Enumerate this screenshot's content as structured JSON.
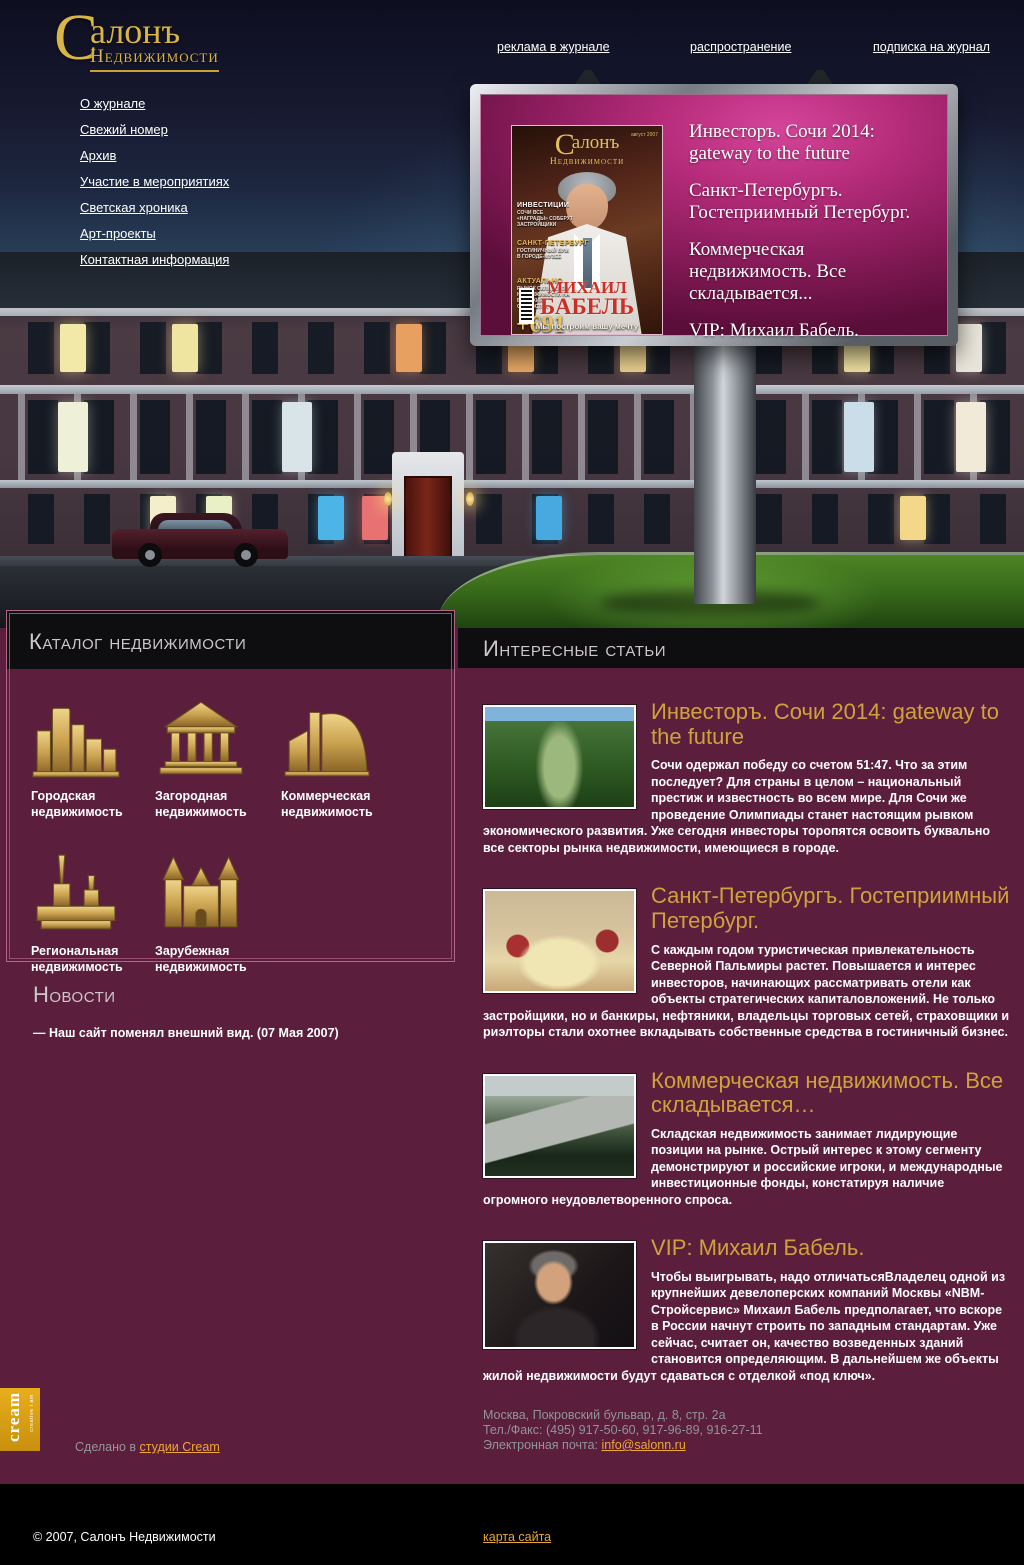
{
  "header": {
    "logo": {
      "initial": "С",
      "word1": "алонъ",
      "word2": "Недвижимости"
    },
    "top_links": [
      {
        "label": "реклама в журнале"
      },
      {
        "label": "распространение"
      },
      {
        "label": "подписка на журнал"
      }
    ]
  },
  "nav": {
    "items": [
      "О журнале",
      "Свежий номер",
      "Архив",
      "Участие в мероприятиях",
      "Светская хроника",
      "Арт-проекты",
      "Контактная информация"
    ]
  },
  "billboard": {
    "headlines": [
      "Инвесторъ. Сочи 2014: gateway to the future",
      "Санкт-Петербургъ. Гостеприимный Петербург.",
      "Коммерческая недвижимость. Все складывается...",
      "VIP: Михаил Бабель."
    ],
    "cover": {
      "logo_initial": "С",
      "logo_word": "алонъ",
      "logo_sub": "Недвижимости",
      "date": "август 2007",
      "rubric1": "ИНВЕСТИЦИИ",
      "rubric1_sub": "СОЧИ ВСЕ «НАГРАДЫ» СОБЕРУТ ЗАСТРОЙЩИКИ",
      "rubric2": "САНКТ-ПЕТЕРБУРГ",
      "rubric2_sub": "ГОСТИНИЧНЫЙ БУМ В ГОРОДЕ-МУЗЕЕ",
      "rubric3": "АКТУАЛЬНО",
      "rubric3_sub": "РЫНОК СКЛАДСКОЙ НЕДВИЖИМОСТИ НА ВЫСОКИХ СКОРОСТЯХ",
      "number": "+691",
      "person_line1": "МИХАИЛ",
      "person_line2": "БАБЕЛЬ",
      "slogan": "Мы построим вашу мечту"
    }
  },
  "catalog": {
    "title": "Каталог недвижимости",
    "items": [
      {
        "label": "Городская недвижимость",
        "icon": "city-buildings-icon"
      },
      {
        "label": "Загородная недвижимость",
        "icon": "country-house-icon"
      },
      {
        "label": "Коммерческая недвижимость",
        "icon": "commercial-building-icon"
      },
      {
        "label": "Региональная недвижимость",
        "icon": "fortress-spire-icon"
      },
      {
        "label": "Зарубежная недвижимость",
        "icon": "castle-icon"
      }
    ]
  },
  "news": {
    "title": "Новости",
    "items": [
      "— Наш сайт поменял внешний вид. (07 Мая 2007)"
    ]
  },
  "articles": {
    "title": "Интересные статьи",
    "items": [
      {
        "title": "Инвесторъ. Сочи 2014: gateway to the future",
        "body": "Сочи одержал победу со счетом 51:47. Что за этим последует? Для страны в целом – национальный престиж и известность во всем мире. Для Сочи же проведение Олимпиады станет настоящим рывком экономического развития. Уже сегодня инвесторы торопятся освоить буквально все секторы рынка недвижимости, имеющиеся в городе."
      },
      {
        "title": "Санкт-Петербургъ. Гостеприимный Петербург.",
        "body": "С каждым годом туристическая привлекательность Северной Пальмиры растет. Повышается и интерес инвесторов, начинающих рассматривать отели как объекты стратегических капиталовложений. Не только застройщики, но и банкиры, нефтяники, владельцы торговых сетей, страховщики и риэлторы стали охотнее вкладывать собственные средства в гостиничный бизнес."
      },
      {
        "title": "Коммерческая недвижимость. Все складывается…",
        "body": "Складская недвижимость занимает лидирующие позиции на рынке. Острый интерес к этому сегменту демонстрируют и российские игроки, и международные инвестиционные фонды, констатируя наличие огромного неудовлетворенного спроса."
      },
      {
        "title": "VIP: Михаил Бабель.",
        "body": "Чтобы выигрывать, надо отличатьсяВладелец одной из крупнейших девелоперских компаний Москвы «NBM-Стройсервис» Михаил Бабель предполагает, что вскоре в России начнут строить по западным стандартам. Уже сейчас, считает он, качество возведенных зданий становится определяющим. В дальнейшем же объекты жилой недвижимости будут сдаваться с отделкой «под ключ»."
      }
    ]
  },
  "footer": {
    "cream_badge": {
      "line1": "cream",
      "line2": "creative i am"
    },
    "credit_prefix": "Сделано в ",
    "credit_link": "студии Cream",
    "address": "Москва, Покровский бульвар, д. 8, стр. 2а",
    "phone": "Тел./Факс: (495) 917-50-60, 917-96-89, 916-27-11",
    "email_label": "Электронная почта: ",
    "email": "info@salonn.ru",
    "copyright": "© 2007, Салонъ Недвижимости",
    "sitemap": "карта сайта"
  },
  "colors": {
    "accent_gold": "#d2a53f",
    "content_maroon": "#5b1f3d",
    "billboard_magenta": "#b82d7c",
    "link_orange": "#f0a638"
  }
}
